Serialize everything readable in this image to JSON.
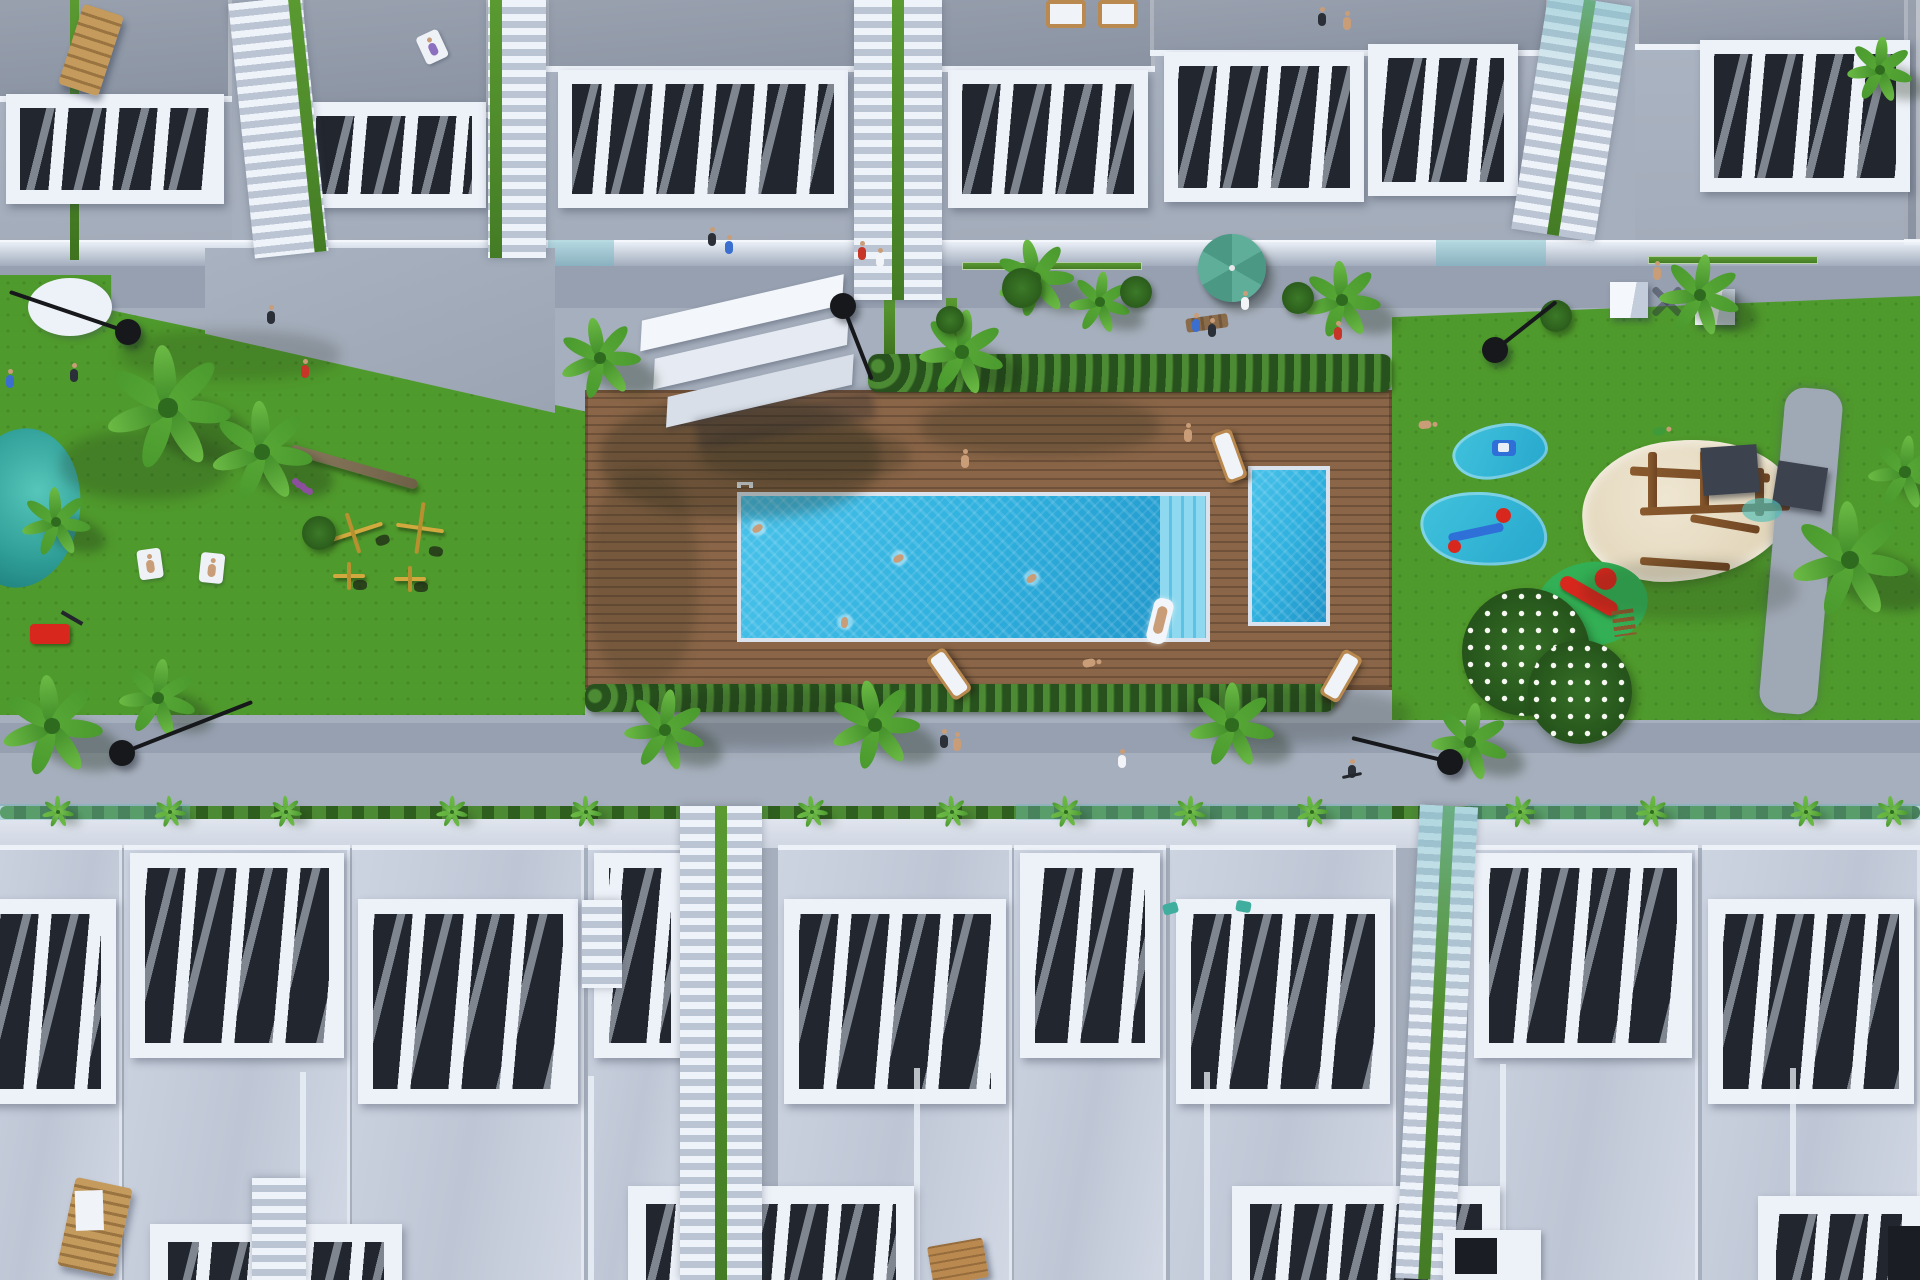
{
  "title": "Aerial 3D architectural render of a residential complex with communal pool, wooden sun deck, lawns, playgrounds and white terraced townhouses",
  "palette": {
    "walkway": "#a6afbd",
    "walkwayShade": "#8e98a8",
    "roof": "#99a1af",
    "roofDark": "#8a93a2",
    "white": "#edf1f8",
    "whiteDim": "#d9dfea",
    "facade": "#c6cedc",
    "terraceDark": "#22272f",
    "lawn": "#4f9a2c",
    "lawnDark": "#3f7f22",
    "deck": "#8a6547",
    "deckLine": "#6f513a",
    "hedge": "#2c5a20",
    "hedgeLite": "#4c8a33",
    "pool": "#2fb0de",
    "poolDeep": "#1f93c8",
    "poolLite": "#8ed9ef",
    "sand": "#e7dcc3",
    "teal": "#2f9f98",
    "tealLite": "#56c6ba",
    "wood": "#b9894f",
    "lamp": "#17181c",
    "skin": "#c99d78",
    "red": "#c63527",
    "blue": "#3a6fd0",
    "purple": "#8d6fc0",
    "parasolA": "#5fae9a",
    "parasolB": "#4b9884",
    "yellow": "#d2a93f",
    "slide": "#d8281e",
    "playGreen": "#33b055",
    "glass": "#bdd3da"
  },
  "scene": {
    "size": [
      1920,
      1280
    ],
    "roofs": [
      [
        -20,
        0,
        252,
        102
      ],
      [
        300,
        0,
        190,
        118
      ],
      [
        545,
        0,
        610,
        72
      ],
      [
        1150,
        0,
        400,
        56
      ],
      [
        1635,
        0,
        285,
        50
      ],
      [
        1904,
        0,
        16,
        245
      ]
    ],
    "patios": [
      [
        -20,
        102,
        252,
        164
      ],
      [
        300,
        118,
        190,
        148
      ],
      [
        545,
        72,
        610,
        194
      ],
      [
        1150,
        56,
        400,
        210
      ],
      [
        1635,
        50,
        285,
        216
      ]
    ],
    "glassBand": [
      0,
      240,
      1920,
      26
    ],
    "tealGlassTop": [
      [
        548,
        240,
        66,
        26
      ],
      [
        1436,
        240,
        110,
        26
      ]
    ],
    "greenCurbs": [
      [
        310,
        262,
        180,
        8
      ],
      [
        962,
        262,
        180,
        8
      ],
      [
        1648,
        256,
        170,
        8
      ]
    ],
    "greenVerts": [
      [
        70,
        0,
        9,
        260
      ],
      [
        884,
        298,
        11,
        58
      ],
      [
        946,
        298,
        11,
        58
      ]
    ],
    "terraces": [
      [
        6,
        94,
        218,
        110
      ],
      [
        302,
        102,
        184,
        106
      ],
      [
        558,
        70,
        290,
        138
      ],
      [
        948,
        70,
        200,
        138
      ],
      [
        1164,
        52,
        200,
        150
      ],
      [
        1368,
        44,
        150,
        152
      ],
      [
        1700,
        40,
        210,
        152
      ]
    ],
    "topStairs": [
      {
        "x": 228,
        "y": 0,
        "w": 74,
        "h": 256,
        "rot": -6,
        "green": "right"
      },
      {
        "x": 488,
        "y": 0,
        "w": 58,
        "h": 258,
        "rot": 0,
        "green": "left"
      },
      {
        "x": 854,
        "y": 0,
        "w": 88,
        "h": 300,
        "rot": 0,
        "green": "mid"
      },
      {
        "x": 1548,
        "y": 0,
        "w": 84,
        "h": 238,
        "rot": 9,
        "green": "mid",
        "teal": true
      }
    ],
    "lawnLeft": {
      "r": [
        0,
        275,
        585,
        440
      ],
      "clip": "polygon(0 0,19% 0,19% 8%,100% 31%,100% 100%,0 100%)"
    },
    "lawnRight": {
      "r": [
        1392,
        296,
        528,
        424
      ],
      "clip": "polygon(0 5%,100% 0,100% 100%,0 100%)"
    },
    "pathTL": {
      "r": [
        205,
        248,
        350,
        165
      ],
      "clip": "polygon(0 0,100% 0,100% 100%,0 52%)"
    },
    "deck": [
      585,
      390,
      807,
      300
    ],
    "hedgeTop": [
      868,
      354,
      524,
      38
    ],
    "hedgeBottom": [
      585,
      684,
      750,
      28
    ],
    "poolMain": [
      737,
      492,
      473,
      150
    ],
    "poolSteps": 46,
    "poolKids": [
      1248,
      466,
      82,
      160
    ],
    "ladder": [
      737,
      482
    ],
    "pond": [
      -38,
      428,
      118,
      160
    ],
    "sand": [
      1582,
      440,
      212,
      140
    ],
    "kidneys": [
      [
        1452,
        424,
        96,
        54,
        -8
      ],
      [
        1420,
        492,
        128,
        74,
        8
      ]
    ],
    "slidePad": [
      1536,
      562,
      112,
      84
    ],
    "flowerBush": [
      [
        1462,
        588,
        128
      ],
      [
        1528,
        640,
        104
      ]
    ],
    "rightPath": [
      1772,
      388,
      58,
      326,
      5
    ],
    "playStructure": {
      "x": 1628,
      "y": 444,
      "beams": [
        [
          2,
          26,
          140,
          9,
          3
        ],
        [
          20,
          8,
          9,
          60,
          0
        ],
        [
          72,
          6,
          9,
          62,
          0
        ],
        [
          127,
          24,
          9,
          48,
          0
        ],
        [
          12,
          61,
          150,
          8,
          -2
        ],
        [
          62,
          76,
          70,
          8,
          10
        ],
        [
          12,
          116,
          90,
          8,
          4
        ]
      ],
      "roofs": [
        [
          74,
          2,
          56,
          48,
          -4
        ],
        [
          147,
          20,
          50,
          44,
          9
        ]
      ],
      "puddle": [
        114,
        54,
        40,
        24
      ]
    },
    "gym": [
      [
        322,
        512,
        62,
        42,
        -18
      ],
      [
        396,
        502,
        48,
        52,
        8
      ],
      [
        333,
        562,
        32,
        28,
        0
      ],
      [
        394,
        566,
        32,
        26,
        0
      ]
    ],
    "mower": [
      30,
      624,
      40,
      20
    ],
    "whiteCurve": [
      28,
      278,
      84,
      58
    ],
    "canopy": {
      "x": 650,
      "y": 296,
      "w": 214,
      "h": 146
    },
    "parasol": {
      "x": 1232,
      "y": 268,
      "r": 34
    },
    "cubes": [
      [
        1610,
        282,
        38,
        36
      ],
      [
        1695,
        289,
        40,
        36
      ]
    ],
    "xShadow": [
      1648,
      298
    ],
    "benchTop": [
      1186,
      316,
      42,
      14,
      -8
    ],
    "roofChairTL": [
      70,
      8,
      42,
      84,
      18
    ],
    "roofLoungers": [
      [
        1046,
        0,
        40,
        28
      ],
      [
        1098,
        0,
        40,
        28
      ]
    ],
    "deckLoungers": [
      [
        1218,
        430,
        -20
      ],
      [
        938,
        648,
        -35
      ],
      [
        1330,
        650,
        30
      ]
    ],
    "float": [
      1150,
      598,
      14
    ],
    "shadows": [
      [
        600,
        398,
        280,
        120,
        0.28
      ],
      [
        920,
        396,
        240,
        60,
        0.22
      ],
      [
        588,
        470,
        110,
        215,
        0.18
      ],
      [
        1582,
        560,
        215,
        60,
        0.18
      ],
      [
        60,
        430,
        170,
        70,
        0.22
      ],
      [
        640,
        688,
        260,
        60,
        0.2
      ],
      [
        1180,
        688,
        230,
        55,
        0.2
      ],
      [
        120,
        330,
        220,
        50,
        0.18
      ],
      [
        700,
        428,
        210,
        54,
        0.22
      ]
    ],
    "walkShadows": [
      [
        0,
        266,
        1920,
        42
      ],
      [
        0,
        723,
        1920,
        30
      ]
    ],
    "planter": {
      "base": [
        0,
        806,
        1920,
        42
      ],
      "hedge": [
        0,
        806,
        1920,
        13
      ],
      "tealGlass": [
        [
          0,
          804,
          190,
          16
        ],
        [
          1016,
          804,
          376,
          16
        ],
        [
          1468,
          804,
          452,
          16
        ]
      ],
      "palmettos": [
        58,
        170,
        286,
        452,
        586,
        812,
        952,
        1066,
        1190,
        1312,
        1520,
        1652,
        1806,
        1892
      ]
    },
    "row1": [
      {
        "x": -30,
        "w": 152,
        "dy": 46
      },
      {
        "x": 124,
        "w": 226,
        "dy": 0
      },
      {
        "x": 352,
        "w": 232,
        "dy": 46
      },
      {
        "x": 588,
        "w": 104,
        "dy": 0
      },
      {
        "x": 778,
        "w": 234,
        "dy": 46
      },
      {
        "x": 1014,
        "w": 152,
        "dy": 0
      },
      {
        "x": 1170,
        "w": 226,
        "dy": 46
      },
      {
        "x": 1468,
        "w": 230,
        "dy": 0
      },
      {
        "x": 1702,
        "w": 218,
        "dy": 46
      }
    ],
    "row1Y": 845,
    "seams": [
      [
        300,
        1072
      ],
      [
        588,
        1076
      ],
      [
        914,
        1068
      ],
      [
        1204,
        1072
      ],
      [
        1500,
        1064
      ],
      [
        1790,
        1068
      ]
    ],
    "row2": [
      {
        "x": 150,
        "y": 1224,
        "w": 252
      },
      {
        "x": 628,
        "y": 1186,
        "w": 286
      },
      {
        "x": 1232,
        "y": 1186,
        "w": 268
      },
      {
        "x": 1758,
        "y": 1196,
        "w": 162
      }
    ],
    "bottomStairs": [
      {
        "x": 680,
        "y": 806,
        "w": 82,
        "h": 474,
        "rot": 0,
        "green": "mid"
      },
      {
        "x": 1420,
        "y": 806,
        "w": 58,
        "h": 474,
        "rot": 3,
        "green": "mid",
        "teal": true
      },
      {
        "x": 252,
        "y": 1178,
        "w": 54,
        "h": 102,
        "rot": 0,
        "green": null
      },
      {
        "x": 582,
        "y": 900,
        "w": 40,
        "h": 88,
        "rot": 0,
        "green": null
      }
    ],
    "stairwell": [
      1443,
      1230,
      98,
      50
    ],
    "doorRight": [
      1888,
      1226,
      32,
      54
    ],
    "benchPallet": [
      930,
      1242,
      56,
      40,
      -10
    ],
    "chairBL": [
      66,
      1182,
      58,
      90,
      12
    ],
    "cushions": [
      [
        1163,
        903,
        15,
        11,
        -15
      ],
      [
        1236,
        901,
        15,
        11,
        10
      ]
    ],
    "trunk": [
      288,
      462,
      132,
      10,
      16
    ],
    "palms": [
      [
        168,
        408,
        64
      ],
      [
        262,
        452,
        52
      ],
      [
        56,
        522,
        36
      ],
      [
        52,
        726,
        52
      ],
      [
        158,
        698,
        40
      ],
      [
        600,
        358,
        42
      ],
      [
        962,
        352,
        44
      ],
      [
        1035,
        278,
        40
      ],
      [
        1100,
        302,
        32
      ],
      [
        1342,
        300,
        40
      ],
      [
        1700,
        295,
        42
      ],
      [
        1880,
        70,
        34
      ],
      [
        1850,
        560,
        60
      ],
      [
        1905,
        472,
        38
      ],
      [
        1470,
        742,
        40
      ],
      [
        665,
        730,
        42
      ],
      [
        875,
        725,
        46
      ],
      [
        1232,
        725,
        44
      ]
    ],
    "bushes": [
      [
        1002,
        268,
        20
      ],
      [
        1120,
        276,
        16
      ],
      [
        1282,
        282,
        16
      ],
      [
        302,
        516,
        17
      ],
      [
        936,
        306,
        14
      ],
      [
        1540,
        300,
        16
      ]
    ],
    "flowersPurple": [
      292,
      478
    ],
    "lamps": [
      {
        "h": [
          843,
          306
        ],
        "a": [
          872,
          380
        ]
      },
      {
        "h": [
          128,
          332
        ],
        "a": [
          10,
          292
        ]
      },
      {
        "h": [
          122,
          753
        ],
        "a": [
          252,
          702
        ]
      },
      {
        "h": [
          1450,
          762
        ],
        "a": [
          1352,
          738
        ]
      },
      {
        "h": [
          1495,
          350
        ],
        "a": [
          1556,
          302
        ]
      }
    ],
    "people": [
      {
        "x": 432,
        "y": 46,
        "c": "purple",
        "l": 1,
        "r": -25,
        "towel": 1
      },
      {
        "x": 1322,
        "y": 16,
        "c": "dark"
      },
      {
        "x": 1347,
        "y": 20,
        "c": "skin"
      },
      {
        "x": 712,
        "y": 236,
        "c": "dark"
      },
      {
        "x": 729,
        "y": 244,
        "c": "blue"
      },
      {
        "x": 862,
        "y": 250,
        "c": "red"
      },
      {
        "x": 880,
        "y": 257,
        "c": "white"
      },
      {
        "x": 271,
        "y": 314,
        "c": "dark"
      },
      {
        "x": 305,
        "y": 368,
        "c": "red"
      },
      {
        "x": 1245,
        "y": 300,
        "c": "white"
      },
      {
        "x": 1657,
        "y": 270,
        "c": "skin"
      },
      {
        "x": 1338,
        "y": 330,
        "c": "red"
      },
      {
        "x": 1196,
        "y": 322,
        "c": "blue"
      },
      {
        "x": 1212,
        "y": 327,
        "c": "dark"
      },
      {
        "x": 965,
        "y": 458,
        "c": "skin"
      },
      {
        "x": 1188,
        "y": 432,
        "c": "skin"
      },
      {
        "x": 1092,
        "y": 662,
        "c": "skin",
        "l": 1,
        "r": 80
      },
      {
        "x": 150,
        "y": 563,
        "c": "skin",
        "l": 1,
        "r": -8,
        "towel": 1
      },
      {
        "x": 212,
        "y": 567,
        "c": "skin",
        "l": 1,
        "r": 6,
        "towel": 1
      },
      {
        "x": 10,
        "y": 378,
        "c": "blue"
      },
      {
        "x": 74,
        "y": 372,
        "c": "dark"
      },
      {
        "x": 944,
        "y": 738,
        "c": "dark"
      },
      {
        "x": 957,
        "y": 741,
        "c": "skin"
      },
      {
        "x": 1122,
        "y": 758,
        "c": "white"
      },
      {
        "x": 1352,
        "y": 768,
        "c": "dark",
        "bike": 1
      },
      {
        "x": 1428,
        "y": 424,
        "c": "skin",
        "l": 1,
        "r": 85
      },
      {
        "x": 1662,
        "y": 430,
        "c": "green",
        "l": 1,
        "r": 75
      }
    ],
    "swimmers": [
      [
        899,
        558
      ],
      [
        1032,
        578
      ],
      [
        845,
        622
      ],
      [
        758,
        528
      ]
    ]
  }
}
